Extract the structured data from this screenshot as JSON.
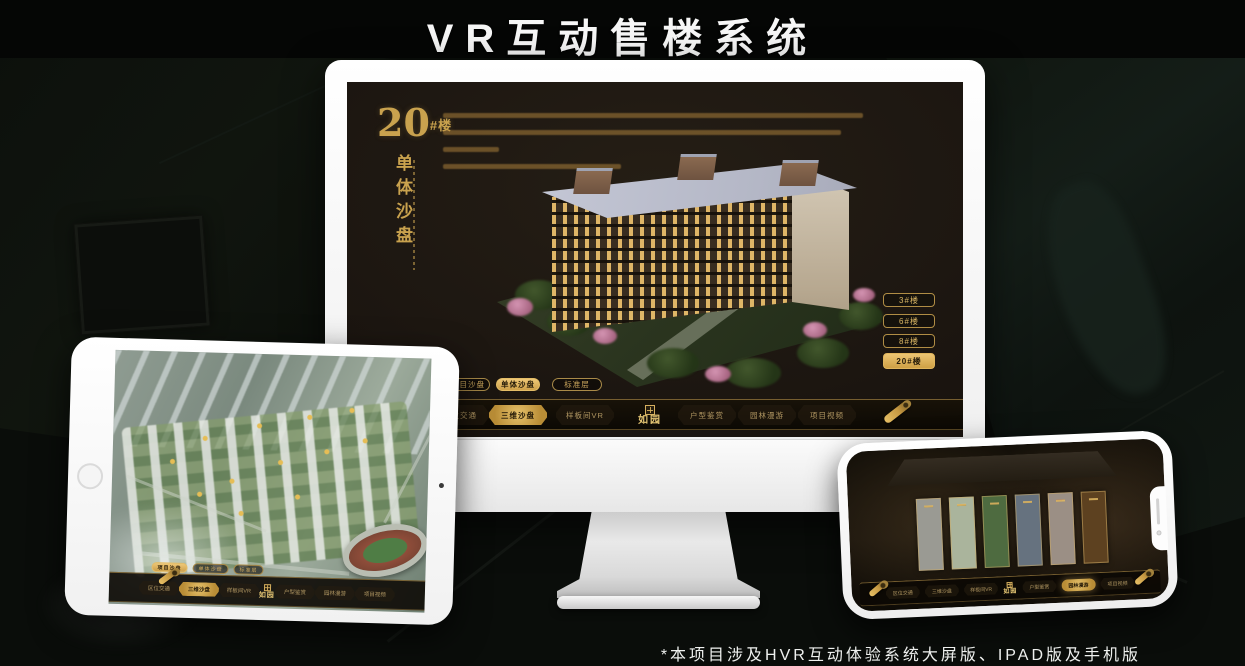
{
  "title": "VR互动售楼系统",
  "footnote": "*本项目涉及HVR互动体验系统大屏版、IPAD版及手机版",
  "logo": "如园",
  "colors": {
    "gold": "#C9A24E",
    "gold_bright": "#E2B964",
    "screen_bg": "#1B1510",
    "nav_bg": "#0C0904",
    "frame_white": "#FFFFFF"
  },
  "nav_items": [
    {
      "label": "区位交通"
    },
    {
      "label": "三维沙盘"
    },
    {
      "label": "样板间VR"
    },
    {
      "label": "户型鉴赏"
    },
    {
      "label": "园林漫游"
    },
    {
      "label": "项目视频"
    }
  ],
  "monitor": {
    "headline": {
      "number": "20",
      "suffix": "#楼",
      "vertical": "单体沙盘"
    },
    "tabs": [
      {
        "label": "项目沙盘"
      },
      {
        "label": "单体沙盘"
      },
      {
        "label": "标准层"
      }
    ],
    "active_tab": "单体沙盘",
    "floor_buttons": [
      {
        "label": "3#楼"
      },
      {
        "label": "6#楼"
      },
      {
        "label": "8#楼"
      },
      {
        "label": "20#楼"
      }
    ],
    "active_floor": "20#楼",
    "nav_active": "三维沙盘"
  },
  "tablet": {
    "tabs": [
      {
        "label": "项目沙盘"
      },
      {
        "label": "单体沙盘"
      },
      {
        "label": "标准层"
      }
    ],
    "active_tab": "项目沙盘",
    "nav_active": "三维沙盘"
  },
  "phone": {
    "nav_active": "园林漫游"
  }
}
